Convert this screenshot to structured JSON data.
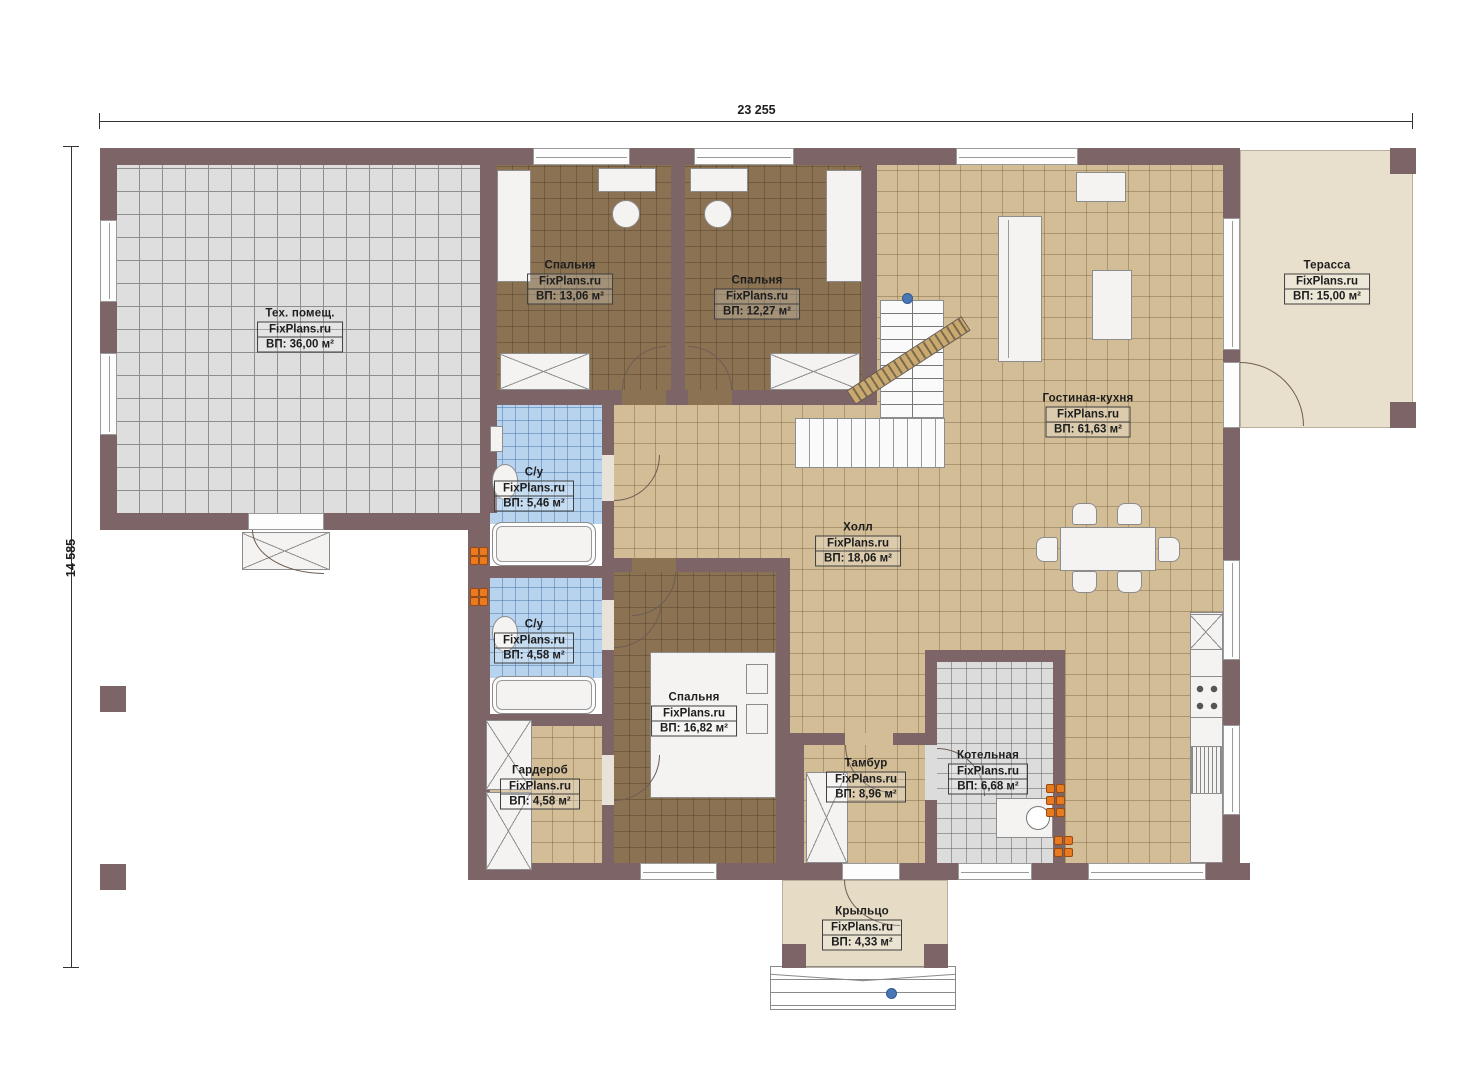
{
  "drawing": {
    "type": "floor-plan",
    "brand": "FixPlans.ru"
  },
  "dimensions": {
    "width": "23 255",
    "height": "14 585"
  },
  "rooms": [
    {
      "id": "tech",
      "name": "Тех. помещ.",
      "brand": "FixPlans.ru",
      "area": "ВП: 36,00 м²"
    },
    {
      "id": "bedroom1",
      "name": "Спальня",
      "brand": "FixPlans.ru",
      "area": "ВП: 13,06 м²"
    },
    {
      "id": "bedroom2",
      "name": "Спальня",
      "brand": "FixPlans.ru",
      "area": "ВП: 12,27 м²"
    },
    {
      "id": "terrace",
      "name": "Терасса",
      "brand": "FixPlans.ru",
      "area": "ВП: 15,00 м²"
    },
    {
      "id": "living",
      "name": "Гостиная-кухня",
      "brand": "FixPlans.ru",
      "area": "ВП: 61,63 м²"
    },
    {
      "id": "bath1",
      "name": "С/у",
      "brand": "FixPlans.ru",
      "area": "ВП: 5,46 м²"
    },
    {
      "id": "hall",
      "name": "Холл",
      "brand": "FixPlans.ru",
      "area": "ВП: 18,06 м²"
    },
    {
      "id": "bath2",
      "name": "С/у",
      "brand": "FixPlans.ru",
      "area": "ВП: 4,58 м²"
    },
    {
      "id": "bedroom3",
      "name": "Спальня",
      "brand": "FixPlans.ru",
      "area": "ВП: 16,82 м²"
    },
    {
      "id": "wardrobe",
      "name": "Гардероб",
      "brand": "FixPlans.ru",
      "area": "ВП: 4,58 м²"
    },
    {
      "id": "tambour",
      "name": "Тамбур",
      "brand": "FixPlans.ru",
      "area": "ВП: 8,96 м²"
    },
    {
      "id": "boiler",
      "name": "Котельная",
      "brand": "FixPlans.ru",
      "area": "ВП: 6,68 м²"
    },
    {
      "id": "porch",
      "name": "Крыльцо",
      "brand": "FixPlans.ru",
      "area": "ВП: 4,33 м²"
    }
  ],
  "colors": {
    "wall": "#7c6467",
    "floor_tech": "#dedede",
    "floor_bedroom": "#8a7253",
    "floor_living": "#d3bd96",
    "floor_bath": "#b7d3ee",
    "floor_terrace": "#e8e0cc",
    "floor_boiler": "#dcdcdc",
    "radiator": "#e87a22",
    "marker": "#4a77b4"
  }
}
